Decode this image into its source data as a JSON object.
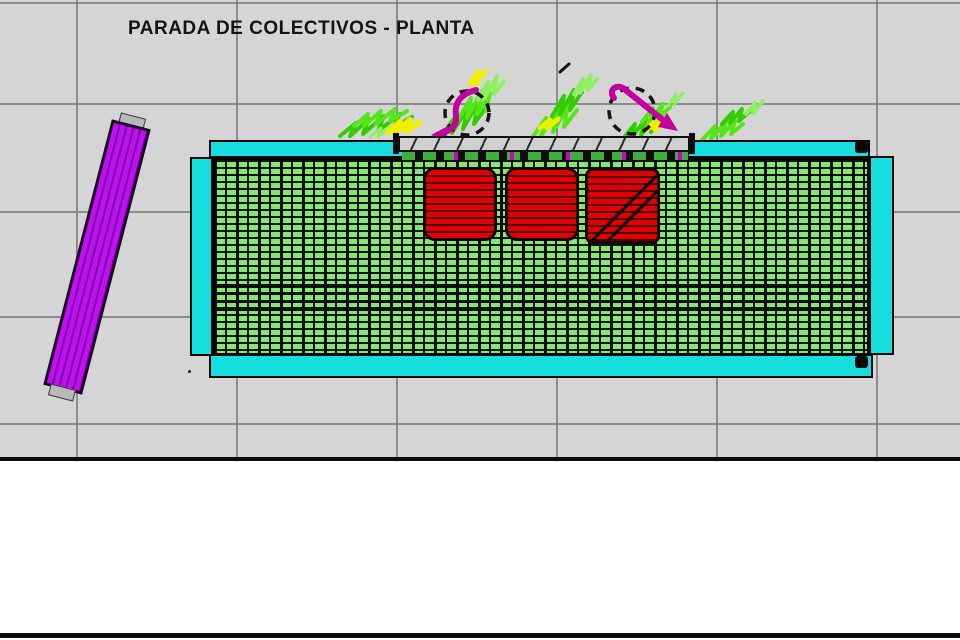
{
  "title": "PARADA DE COLECTIVOS - PLANTA",
  "colors": {
    "sheet_bg": "#d5d5d5",
    "grid_line": "#8c8c8c",
    "frame_cyan": "#17dede",
    "roof_slat_green": "#84e673",
    "seat_red": "#e00000",
    "bench_gray": "#cfcfcf",
    "ramp_purple": "#bf10ef",
    "rotation_arrow_magenta": "#c2009e",
    "vegetation_green": "#33cc00",
    "vegetation_yellow": "#eef000"
  },
  "counts": {
    "seats": 3,
    "rotation_symbols": 2
  }
}
